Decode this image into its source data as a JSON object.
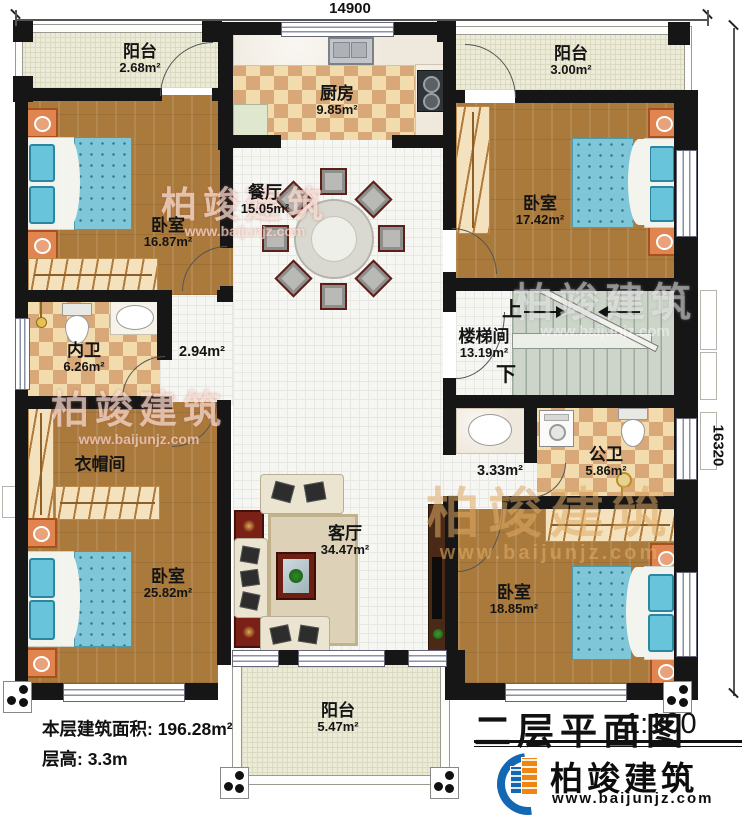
{
  "dimensions": {
    "width_top": "14900",
    "height_right": "16320"
  },
  "title_block": {
    "title": "二层平面图",
    "scale": "1:100"
  },
  "info": {
    "floor_area": "本层建筑面积: 196.28m²",
    "floor_height": "层高: 3.3m"
  },
  "brand": {
    "name": "柏竣建筑",
    "website": "www.baijunjz.com"
  },
  "watermark": {
    "name": "柏竣建筑",
    "website": "www.baijunjz.com"
  },
  "rooms": {
    "balcony_tl": {
      "name": "阳台",
      "area": "2.68m²"
    },
    "kitchen": {
      "name": "厨房",
      "area": "9.85m²"
    },
    "balcony_tr": {
      "name": "阳台",
      "area": "3.00m²"
    },
    "bedroom_tl": {
      "name": "卧室",
      "area": "16.87m²"
    },
    "dining": {
      "name": "餐厅",
      "area": "15.05m²"
    },
    "bedroom_tr": {
      "name": "卧室",
      "area": "17.42m²"
    },
    "stairwell": {
      "name": "楼梯间",
      "area": "13.19m²",
      "up": "上",
      "down": "下"
    },
    "bath_inner": {
      "name": "内卫",
      "area": "6.26m²"
    },
    "corridor_a": {
      "area": "2.94m²"
    },
    "cloakroom": {
      "name": "衣帽间"
    },
    "living": {
      "name": "客厅",
      "area": "34.47m²"
    },
    "corridor_b": {
      "area": "3.33m²"
    },
    "bath_public": {
      "name": "公卫",
      "area": "5.86m²"
    },
    "bedroom_bl": {
      "name": "卧室",
      "area": "25.82m²"
    },
    "bedroom_br": {
      "name": "卧室",
      "area": "18.85m²"
    },
    "balcony_b": {
      "name": "阳台",
      "area": "5.47m²"
    }
  }
}
